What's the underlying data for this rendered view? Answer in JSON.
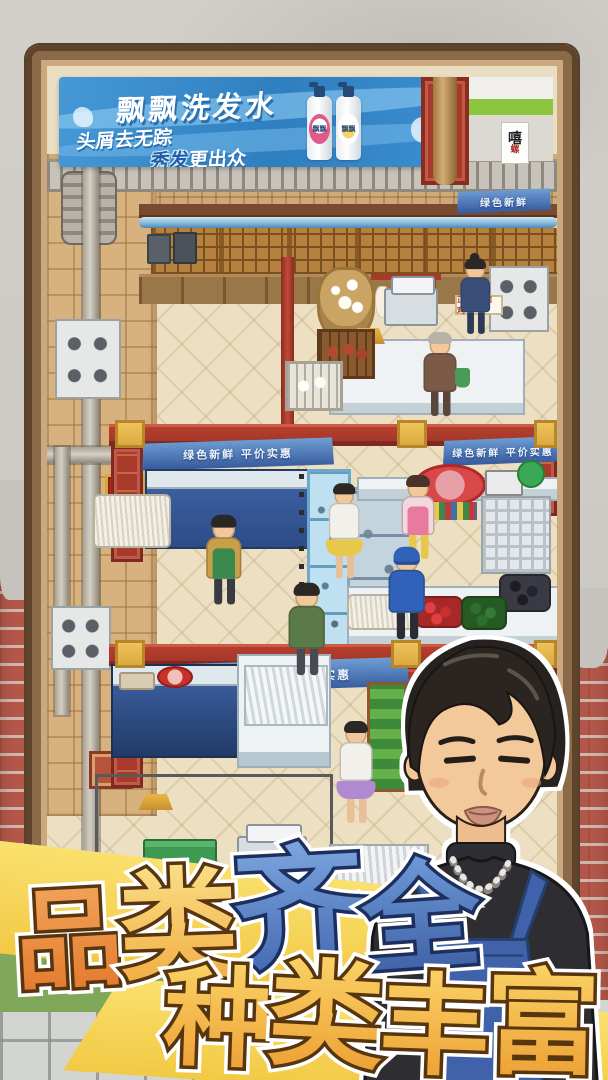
{
  "ad_banner": {
    "brand": "飘飘洗发水",
    "slogan1": "头屑去无踪",
    "slogan2_accent": "秀发",
    "slogan2_rest": "更出众",
    "bottle1_label": "飘飘",
    "bottle2_label": "飘飘"
  },
  "side_sign": {
    "char1": "嘻",
    "char2": "螺"
  },
  "market": {
    "banner_top_right": "绿色新鲜",
    "banner_mid": "绿色新鲜 平价实惠",
    "banner_mid_right": "绿色新鲜 平价实惠",
    "banner_lower": "绿色新鲜 平价实惠",
    "poultry_sign": "正宗走地鸡"
  },
  "promo": {
    "line1": [
      "品",
      "类",
      "齐",
      "全"
    ],
    "line2": [
      "种",
      "类",
      "丰",
      "富"
    ]
  },
  "colors": {
    "ribbon_yellow": "#f2c944",
    "promo_orange": "#e2762a",
    "promo_gold": "#f5b952",
    "promo_blue": "#3f63ad",
    "banner_blue": "#35589c",
    "beam_red": "#a93a2c",
    "apron_blue": "#3f62ab",
    "ad_blue": "#3b8ed0"
  }
}
